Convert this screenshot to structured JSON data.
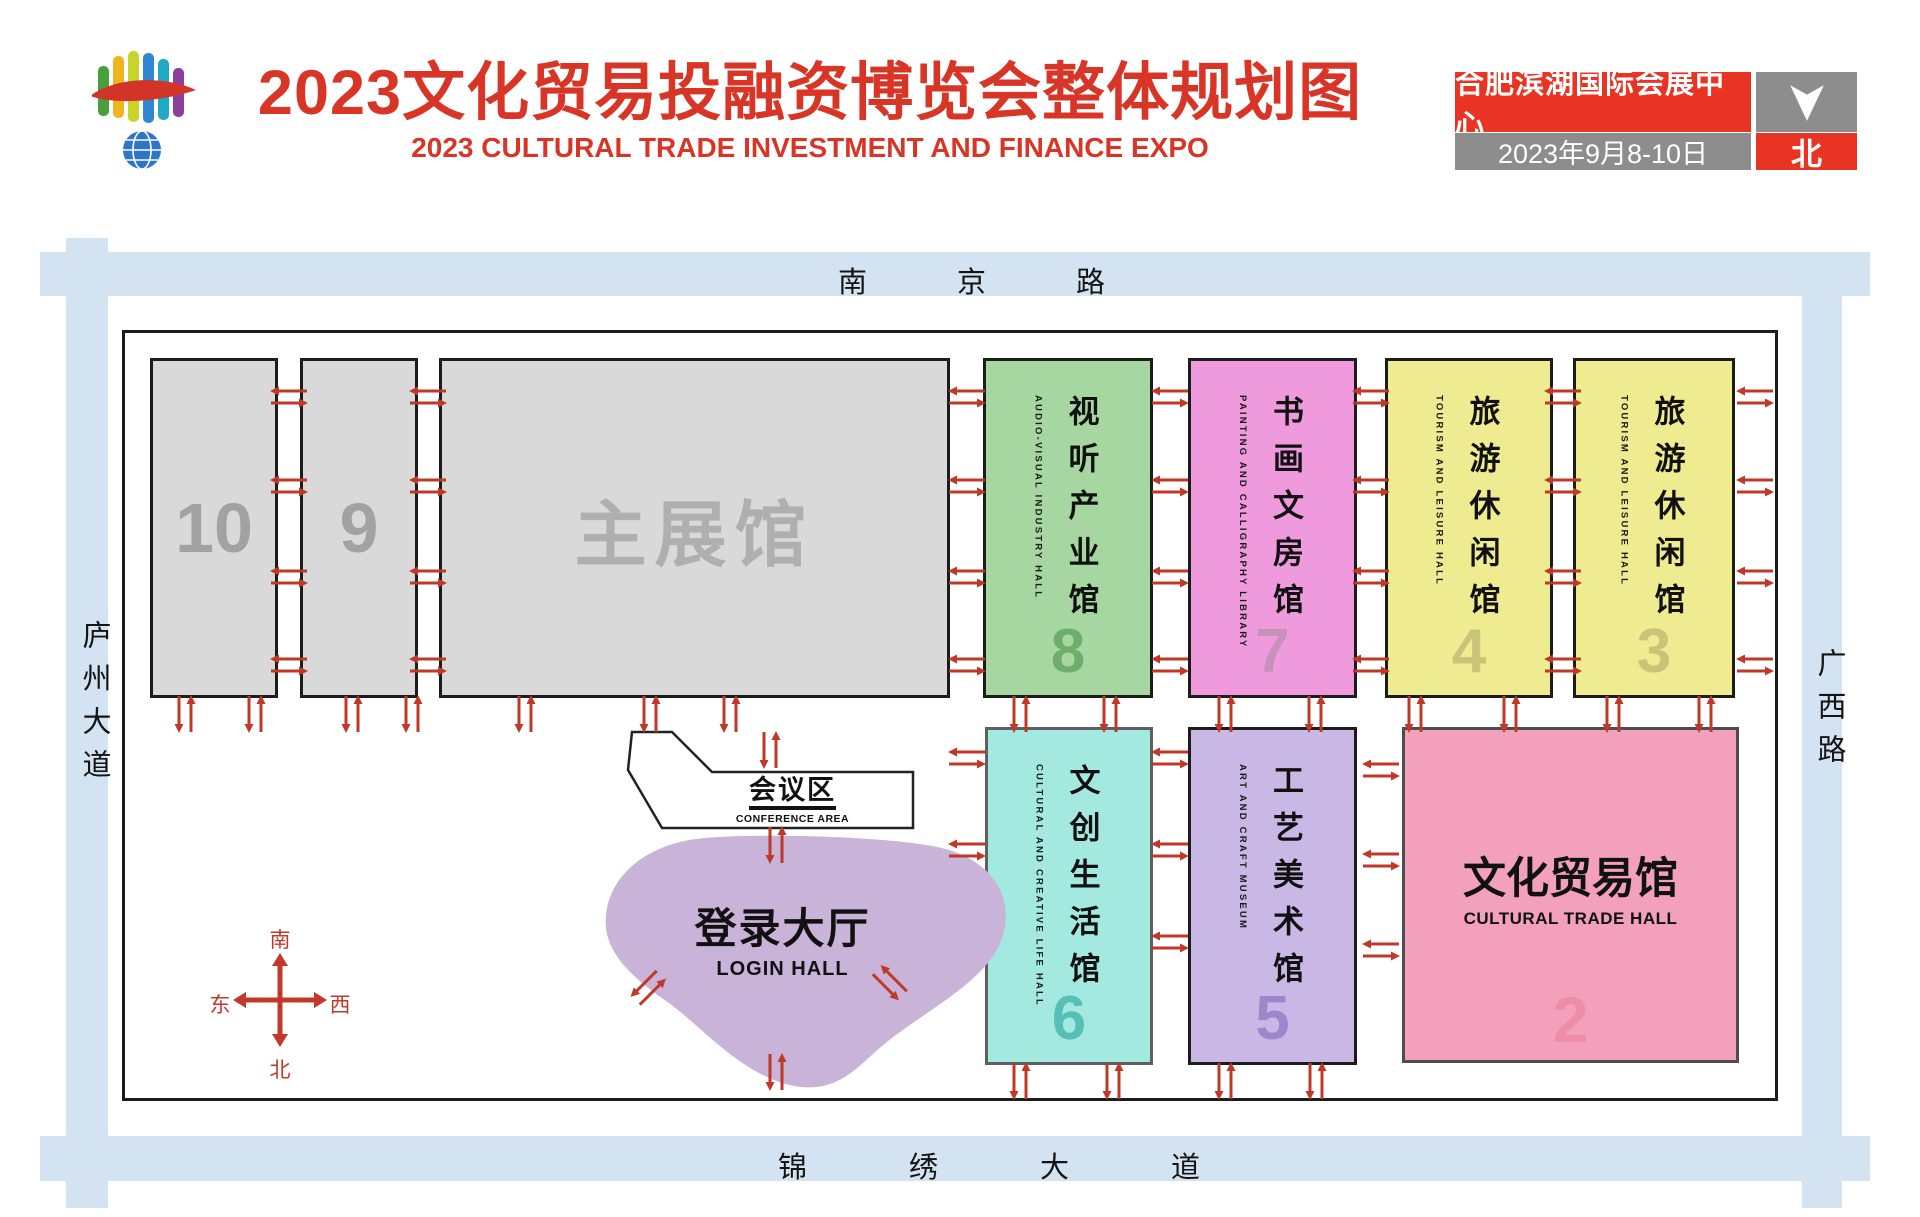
{
  "header": {
    "title_cn": "2023文化贸易投融资博览会整体规划图",
    "title_en": "2023 CULTURAL TRADE INVESTMENT AND FINANCE EXPO",
    "venue_badge": "合肥滨湖国际会展中心",
    "date_badge": "2023年9月8-10日",
    "north_badge": "北"
  },
  "roads": {
    "top": "南京路",
    "left": "庐州大道",
    "right": "广西路",
    "bottom": "锦绣大道"
  },
  "compass": {
    "south": "南",
    "north": "北",
    "east": "东",
    "west": "西"
  },
  "halls": {
    "h10": {
      "number": "10",
      "color": "#d9d9d9"
    },
    "h9": {
      "number": "9",
      "color": "#d9d9d9"
    },
    "main": {
      "name_cn": "主展馆",
      "color": "#d9d9d9"
    },
    "h8": {
      "number": "8",
      "name_cn": "视听产业馆",
      "name_en": "AUDIO-VISUAL INDUSTRY HALL",
      "color": "#a6d7a0"
    },
    "h7": {
      "number": "7",
      "name_cn": "书画文房馆",
      "name_en": "PAINTING AND CALLIGRAPHY LIBRARY",
      "color": "#f09ade"
    },
    "h4": {
      "number": "4",
      "name_cn": "旅游休闲馆",
      "name_en": "TOURISM AND LEISURE HALL",
      "color": "#eeeb90"
    },
    "h3": {
      "number": "3",
      "name_cn": "旅游休闲馆",
      "name_en": "TOURISM AND LEISURE HALL",
      "color": "#eeeb90"
    },
    "h6": {
      "number": "6",
      "name_cn": "文创生活馆",
      "name_en": "CULTURAL AND CREATIVE LIFE HALL",
      "color": "#a3e9e0"
    },
    "h5": {
      "number": "5",
      "name_cn": "工艺美术馆",
      "name_en": "ART AND CRAFT MUSEUM",
      "color": "#c9b7e6"
    },
    "h2": {
      "number": "2",
      "name_cn": "文化贸易馆",
      "name_en": "CULTURAL TRADE HALL",
      "color": "#f2a0bb"
    }
  },
  "areas": {
    "conference": {
      "name_cn": "会议区",
      "name_en": "CONFERENCE AREA",
      "color": "#ffffff"
    },
    "login": {
      "name_cn": "登录大厅",
      "name_en": "LOGIN HALL",
      "color": "#c9b3d8"
    }
  },
  "colors": {
    "title_red": "#d93527",
    "badge_red": "#e93323",
    "badge_gray": "#8d8d8d",
    "road_blue": "#d3e3f1",
    "arrow_red": "#bf3928",
    "compass_red": "#c0392b"
  }
}
